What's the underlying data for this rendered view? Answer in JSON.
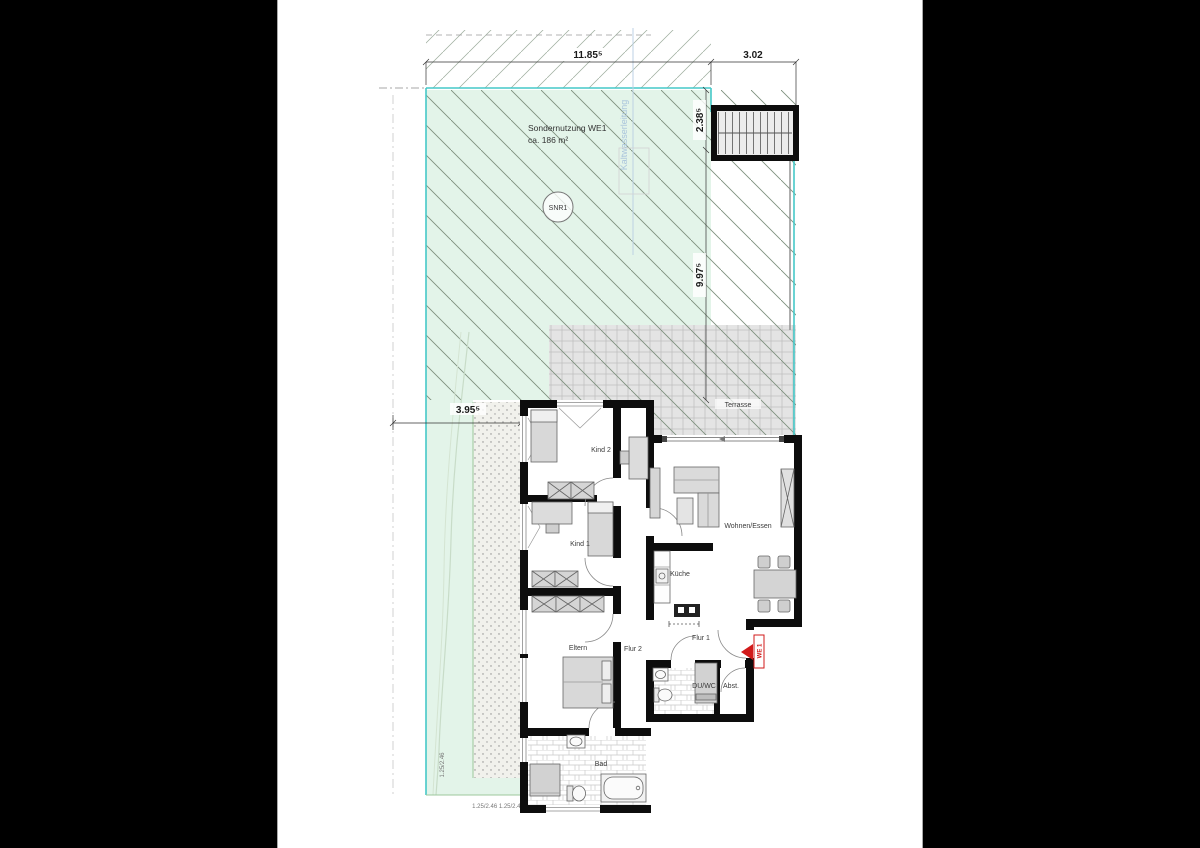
{
  "site": {
    "labels": {
      "sondernutzung1": "Sondernutzung WE1",
      "sondernutzung2": "ca. 186 m²",
      "snr": "SNR1",
      "waterline": "Kaltwasserleitung",
      "terrasse": "Terrasse",
      "unit_marker": "WE 1"
    },
    "dims": {
      "top_left": "11.85⁵",
      "top_right": "3.02",
      "right_upper": "2.38⁵",
      "right_lower": "9.97⁵",
      "left": "3.95⁵",
      "window_note_vertical": "1.25/2.46",
      "window_note_bottom": "1.25/2.46 1.25/2.46"
    }
  },
  "rooms": {
    "kind2": "Kind 2",
    "kind1": "Kind 1",
    "eltern": "Eltern",
    "flur2": "Flur 2",
    "flur1": "Flur 1",
    "kueche": "Küche",
    "wohnen": "Wohnen/Essen",
    "bad": "Bad",
    "duwc": "DU/WC",
    "abst": "Abst."
  },
  "colors": {
    "background": "#000000",
    "paper": "#ffffff",
    "site_green": "#e3f4e9",
    "boundary_teal": "#45c8c8",
    "hatch": "#7d8f7d",
    "wall": "#0d0d0d",
    "terrace_grey": "#e4e4e4",
    "accent_red": "#d11a1a"
  }
}
